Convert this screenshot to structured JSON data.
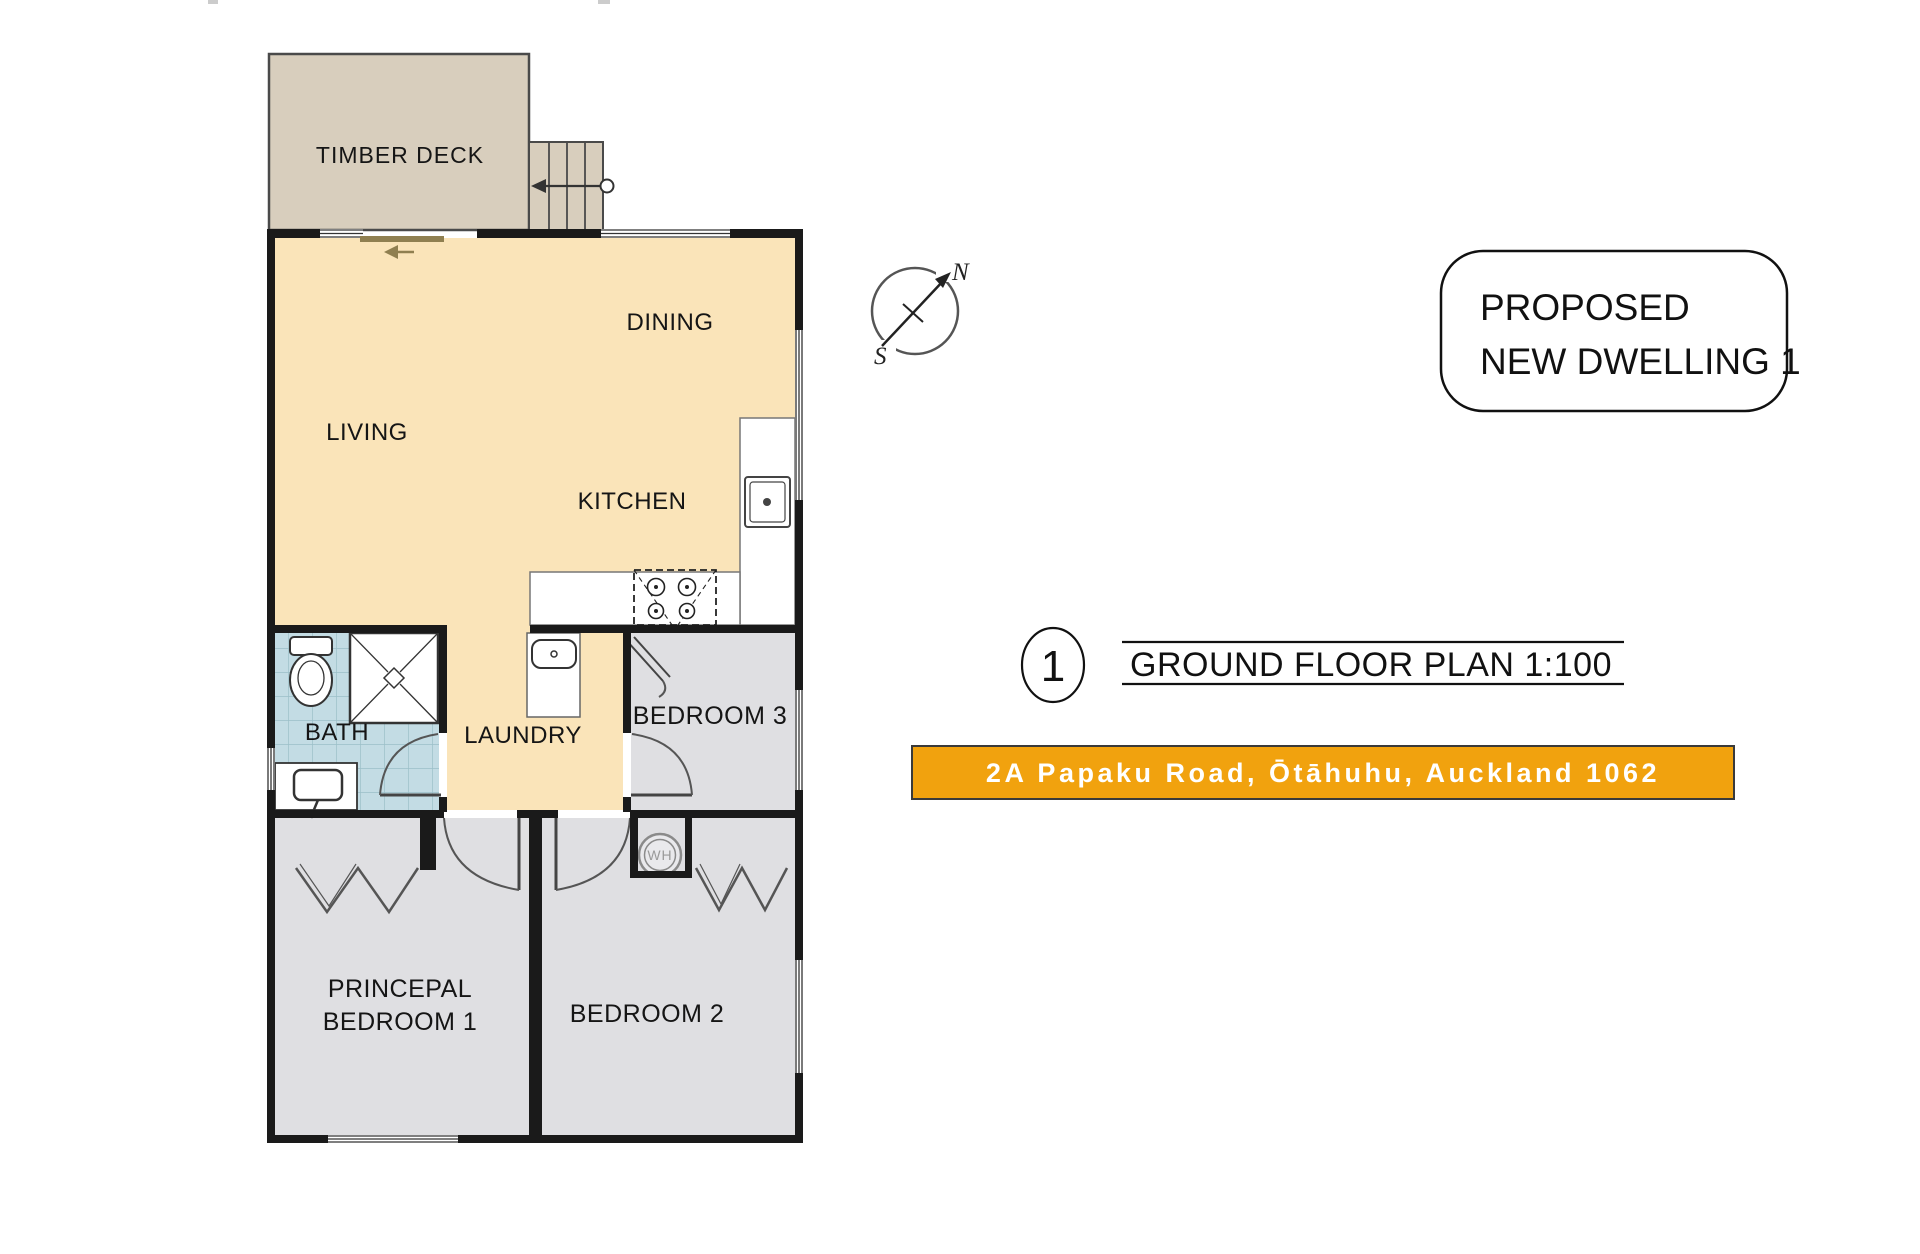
{
  "plan": {
    "labels": {
      "timber_deck": "TIMBER DECK",
      "dining": "DINING",
      "living": "LIVING",
      "kitchen": "KITCHEN",
      "bath": "BATH",
      "laundry": "LAUNDRY",
      "bedroom3": "BEDROOM 3",
      "principal_line1": "PRINCEPAL",
      "principal_line2": "BEDROOM 1",
      "bedroom2": "BEDROOM 2",
      "water_heater": "WH"
    },
    "colors": {
      "floor_cream": "#FAE4B9",
      "deck_tan": "#D8CEBD",
      "room_gray": "#DFDFE2",
      "bath_blue": "#C3DCE4",
      "banner_orange": "#F1A20E"
    }
  },
  "compass": {
    "north": "N",
    "south": "S"
  },
  "title_box": {
    "line1": "PROPOSED",
    "line2": "NEW DWELLING 1"
  },
  "plan_title": {
    "number": "1",
    "label": "GROUND FLOOR PLAN  1:100"
  },
  "address_bar": {
    "text": "2A Papaku Road, Ōtāhuhu, Auckland 1062",
    "text_color": "#FFFFFF"
  }
}
